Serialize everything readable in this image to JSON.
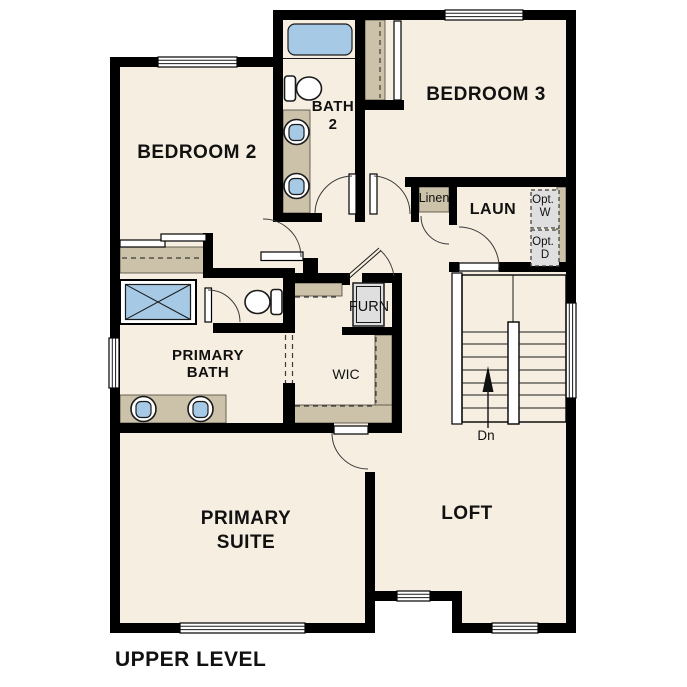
{
  "plan": {
    "title": "UPPER LEVEL",
    "labels": {
      "bedroom2": "BEDROOM 2",
      "bath2_l1": "BATH",
      "bath2_l2": "2",
      "bedroom3": "BEDROOM 3",
      "linen": "Linen",
      "laundry": "LAUN",
      "opt_w_l1": "Opt.",
      "opt_w_l2": "W",
      "opt_d_l1": "Opt.",
      "opt_d_l2": "D",
      "furnace": "FURN",
      "wic": "WIC",
      "primary_bath_l1": "PRIMARY",
      "primary_bath_l2": "BATH",
      "primary_suite_l1": "PRIMARY",
      "primary_suite_l2": "SUITE",
      "loft": "LOFT",
      "stairs_down": "Dn"
    },
    "colors": {
      "wall": "#000000",
      "floor": "#f6efe1",
      "casework_tan": "#ccc1a9",
      "fixture_blue": "#a6c9e6",
      "equipment_gray": "#dfdfdf",
      "background": "#ffffff"
    }
  }
}
